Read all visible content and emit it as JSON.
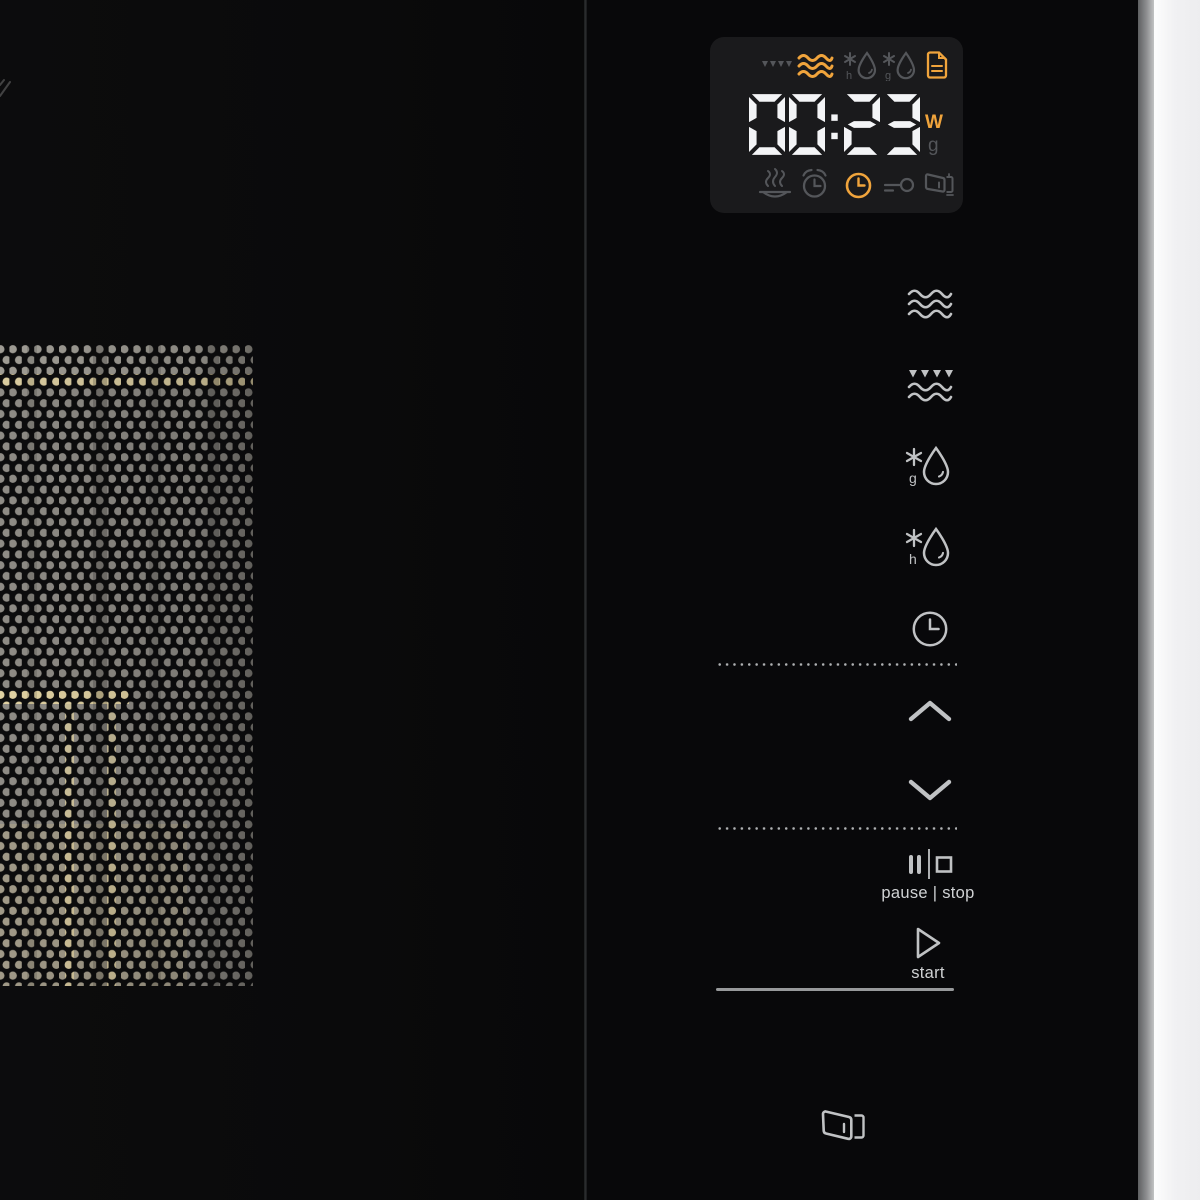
{
  "display": {
    "time": "00:23",
    "unit_top": {
      "label": "W",
      "state": "active"
    },
    "unit_bottom": {
      "label": "g",
      "state": "inactive"
    },
    "top_indicators": [
      {
        "name": "grill-indicator",
        "state": "inactive"
      },
      {
        "name": "microwave-indicator",
        "state": "active"
      },
      {
        "name": "defrost-time-indicator",
        "state": "inactive"
      },
      {
        "name": "defrost-weight-indicator",
        "state": "inactive"
      },
      {
        "name": "auto-program-indicator",
        "state": "active"
      }
    ],
    "bottom_indicators": [
      {
        "name": "keep-warm-indicator",
        "state": "inactive"
      },
      {
        "name": "timer-indicator",
        "state": "inactive"
      },
      {
        "name": "clock-indicator",
        "state": "active"
      },
      {
        "name": "child-lock-indicator",
        "state": "inactive"
      },
      {
        "name": "door-indicator",
        "state": "inactive"
      }
    ],
    "colors": {
      "active": "#f0a43c",
      "inactive": "#54565a",
      "digits": "#f3f4f6",
      "panel_bg": "#1a1a1c"
    }
  },
  "controls": {
    "function_buttons": [
      {
        "name": "microwave-button"
      },
      {
        "name": "grill-button"
      },
      {
        "name": "defrost-weight-button"
      },
      {
        "name": "defrost-time-button"
      },
      {
        "name": "clock-button"
      }
    ],
    "pause_stop": {
      "label": "pause | stop"
    },
    "start": {
      "label": "start"
    },
    "icon_color": "#c0c2c4",
    "label_color": "#d0d2d4"
  }
}
